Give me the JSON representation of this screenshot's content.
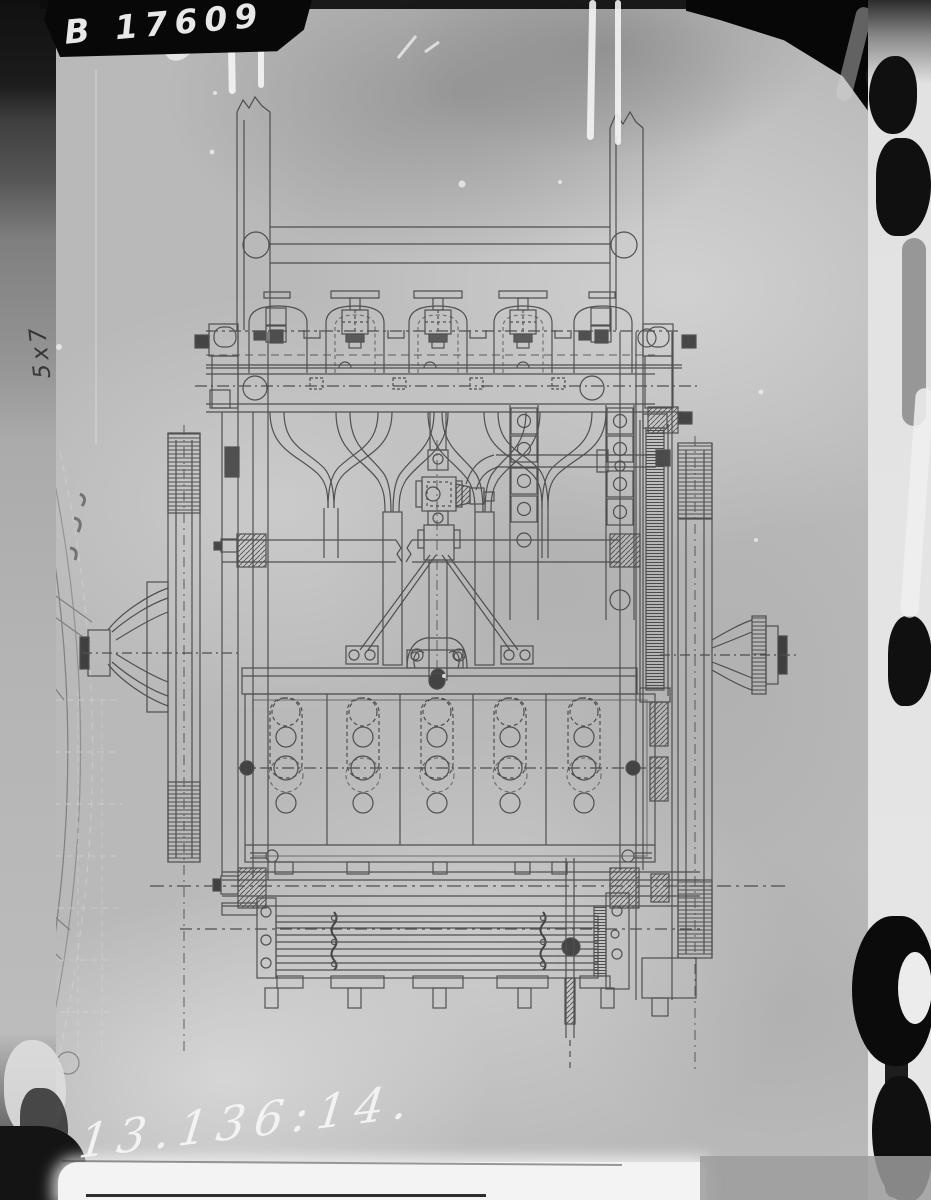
{
  "annotations": {
    "plate_id": "B 17609",
    "catalog_number": "13.136:14.",
    "size_note": "5x7"
  },
  "colors": {
    "plate_background": "#b9b9b9",
    "drawing_ink": "#3c3c3c",
    "label_background": "#080808",
    "label_text": "#e8e8e8",
    "handwriting_white": "#f4f4f4",
    "border_black": "#0c0c0c"
  }
}
